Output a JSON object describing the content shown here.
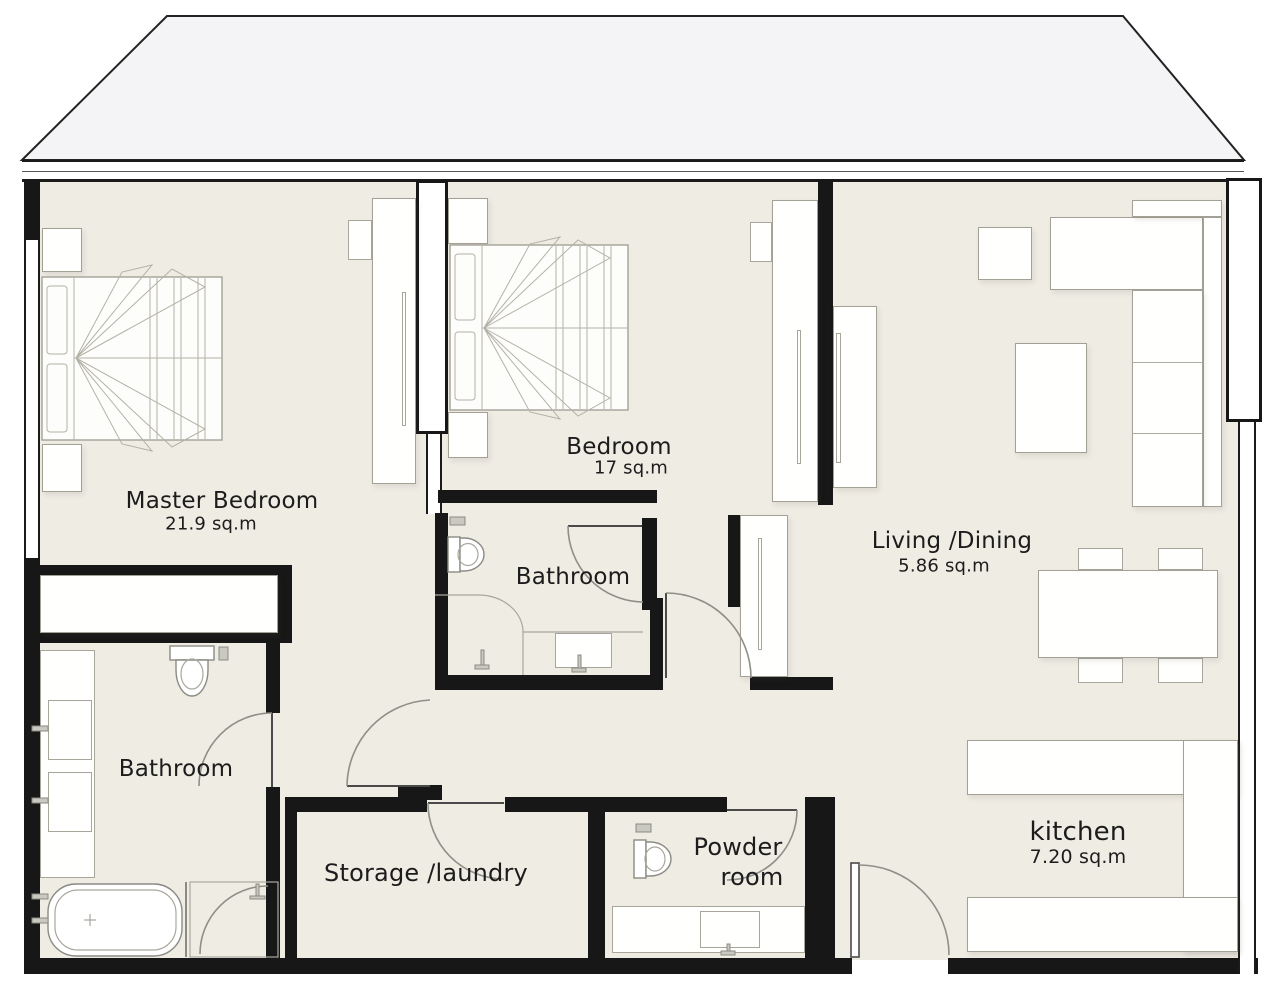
{
  "plan_title": "apartment-floor-plan",
  "rooms": [
    {
      "id": "master-bedroom",
      "name": "Master Bedroom",
      "area": "21.9 sq.m"
    },
    {
      "id": "bedroom",
      "name": "Bedroom",
      "area": "17 sq.m"
    },
    {
      "id": "bathroom-middle",
      "name": "Bathroom",
      "area": ""
    },
    {
      "id": "bathroom-master",
      "name": "Bathroom",
      "area": ""
    },
    {
      "id": "living-dining",
      "name": "Living /Dining",
      "area": "5.86 sq.m"
    },
    {
      "id": "storage-laundry",
      "name": "Storage /laundry",
      "area": ""
    },
    {
      "id": "powder-room",
      "line1": "Powder",
      "line2": "room"
    },
    {
      "id": "kitchen",
      "name": "kitchen",
      "area": "7.20 sq.m"
    }
  ],
  "colors": {
    "floor": "#efece4",
    "wall": "#171717",
    "roof": "#f4f4f7",
    "furniture_outline": "#a3a196",
    "door_arc": "#8f8f88",
    "text": "#1c1c1c"
  }
}
